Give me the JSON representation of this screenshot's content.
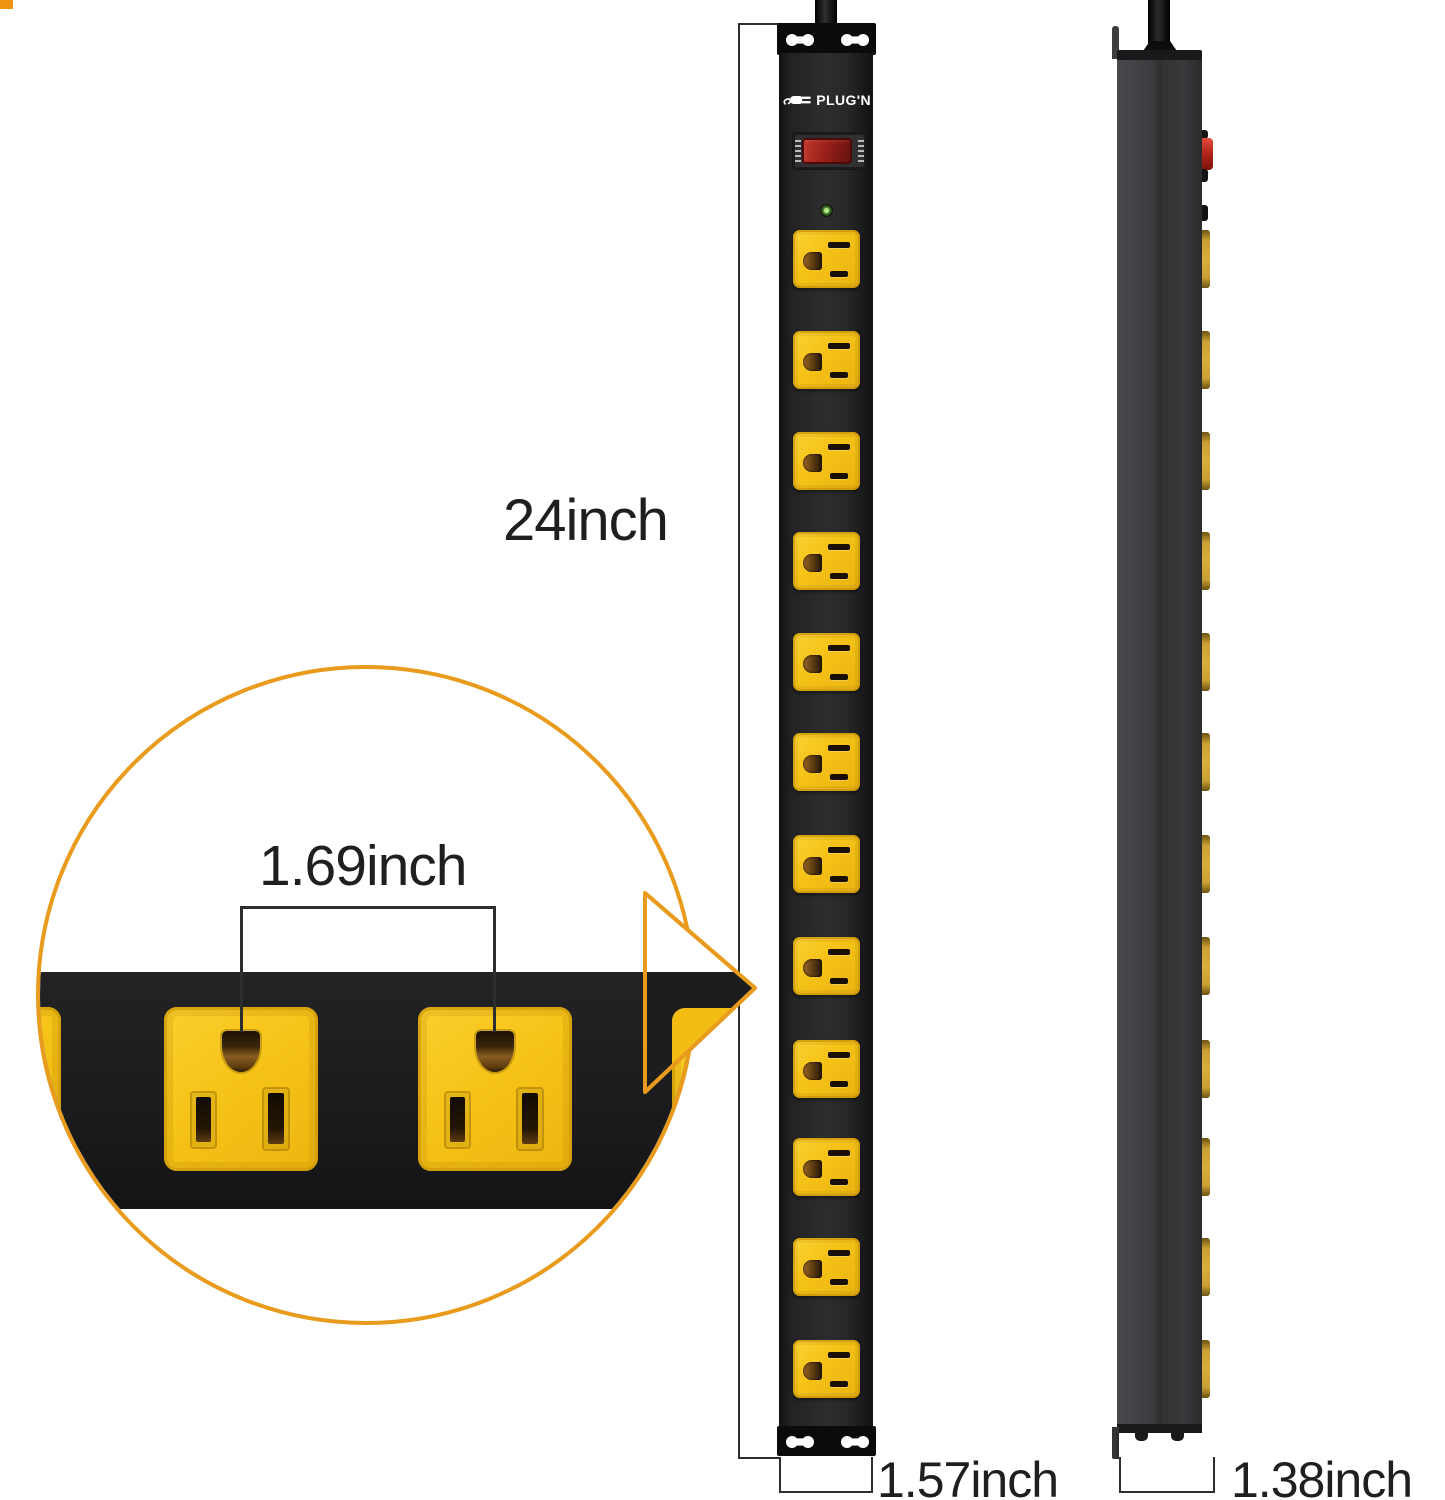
{
  "labels": {
    "height": "24inch",
    "outlet_spacing": "1.69inch",
    "front_width": "1.57inch",
    "side_depth": "1.38inch"
  },
  "brand": {
    "name": "PLUG'N"
  },
  "front_view": {
    "outlet_count": 12,
    "has_power_switch": true,
    "has_led": true
  },
  "side_view": {
    "outlet_bump_count": 12
  },
  "inset_view": {
    "full_outlets_visible": 2
  },
  "colors": {
    "accent_orange": "#E89B1C",
    "outlet_yellow": "#F6C318",
    "switch_red": "#B5271C",
    "led_green": "#4F8C34",
    "strip_black": "#232325",
    "side_gray": "#3B3B3E"
  }
}
